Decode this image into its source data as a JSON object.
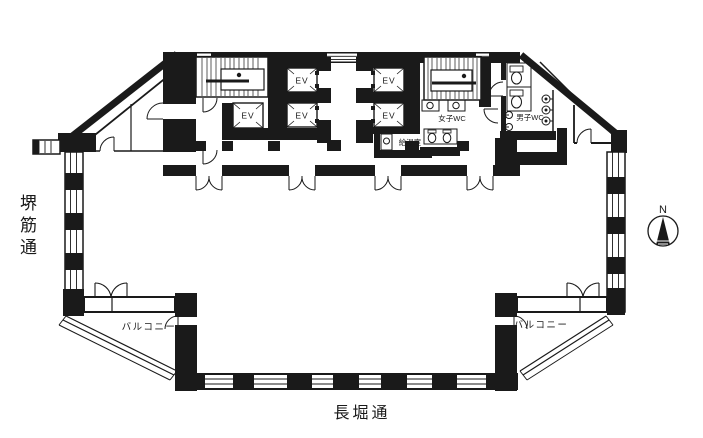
{
  "streets": {
    "west": "堺筋通",
    "south": "長堀通"
  },
  "compass": {
    "north": "N"
  },
  "labels": {
    "balcony_left": "バルコニー",
    "balcony_right": "バルコニー",
    "womens_wc": "女子WC",
    "mens_wc": "男子WC",
    "kitchenette": "給湯室"
  },
  "elevators": {
    "labels": [
      "EV",
      "EV",
      "EV",
      "EV",
      "EV"
    ]
  },
  "colors": {
    "ink": "#1a1a1a",
    "background": "#ffffff"
  }
}
